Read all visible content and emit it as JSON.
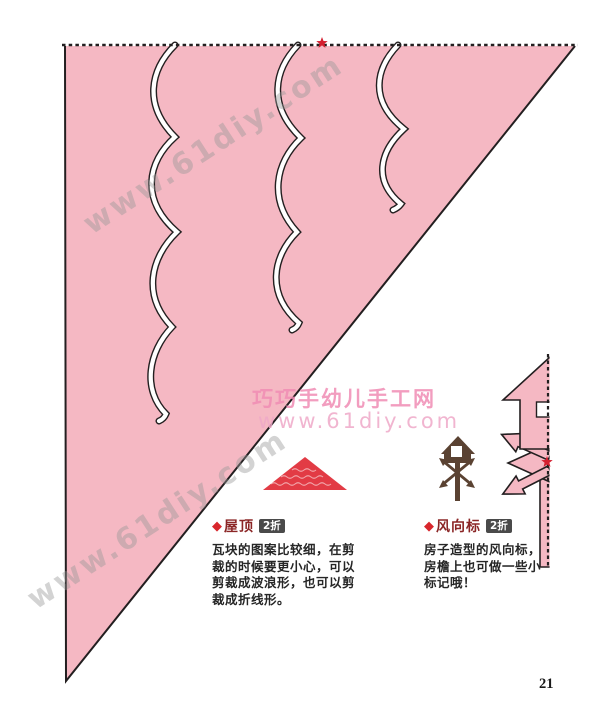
{
  "page": {
    "number": "21"
  },
  "watermarks": {
    "diagonal_text": "www.61diy.com",
    "center_line1": "巧巧手幼儿手工网",
    "center_line2": "www.61diy.com"
  },
  "markers": {
    "fold_star": "★",
    "bullet_diamond": "◆"
  },
  "sections": {
    "roof": {
      "bullet": "◆",
      "title": "屋顶",
      "badge": "2折",
      "lines": [
        "瓦块的图案比较细，在剪",
        "裁的时候要更小心，可以",
        "剪裁成波浪形，也可以剪",
        "裁成折线形。"
      ]
    },
    "vane": {
      "bullet": "◆",
      "title": "风向标",
      "badge": "2折",
      "lines": [
        "房子造型的风向标，",
        "房檐上也可做一些小",
        "标记哦！"
      ]
    }
  },
  "colors": {
    "paper_pink": "#f5b8c3",
    "outline_black": "#231f20",
    "star_red": "#d42030",
    "roof_red": "#e23b45",
    "vane_brown": "#5a4232",
    "title_maroon": "#8b2626",
    "badge_bg": "#4a4a4a",
    "watermark_gray": "#9e9e9e",
    "watermark_pink": "#f08cb4"
  }
}
